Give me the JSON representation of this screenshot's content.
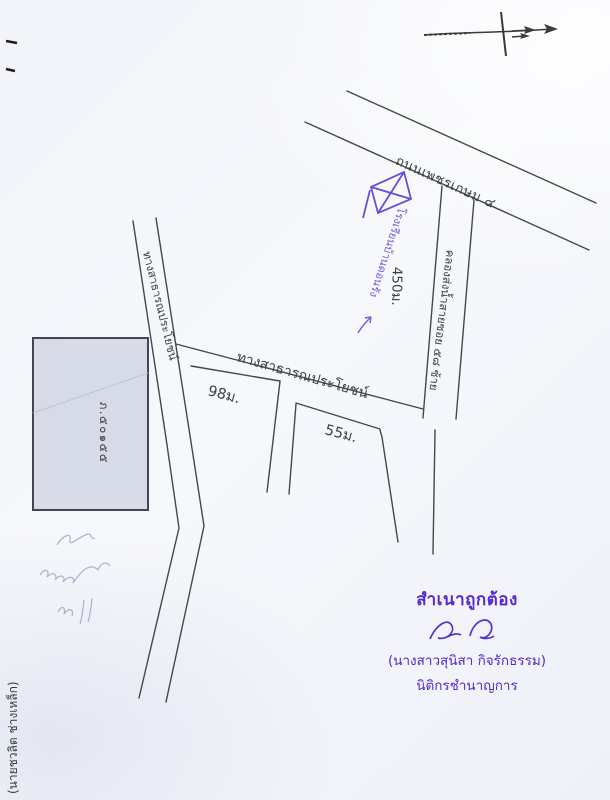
{
  "map": {
    "roads": {
      "phetkasem": {
        "label": "ถนนเพชรเกษม ๔"
      },
      "public_road_diagonal": {
        "label": "ทางสาธารณประโยชน์"
      },
      "public_road_middle": {
        "label": "ทางสาธารณประโยชน์"
      },
      "canal": {
        "label": "คลองส่งน้ำสายซอย ๕๘ ซ้าย"
      }
    },
    "distances": {
      "along_canal": "450ม.",
      "segment_left": "98ม.",
      "segment_right": "55ม."
    },
    "landmarks": {
      "school": {
        "label": "โรงเรียนบ้านดอนรัง"
      },
      "parcel": {
        "label": "ภ.๕๐๑๕๕"
      }
    }
  },
  "certification": {
    "heading": "สำเนาถูกต้อง",
    "name": "(นางสาวสุนิสา  กิจรักธรรม)",
    "title": "นิติกรชำนาญการ"
  },
  "side_note": {
    "name": "(นายชวลิต  ช่างเหล็ก)"
  },
  "colors": {
    "ink_line": "#414b45",
    "stamp_purple": "#5429cf",
    "pen_purple": "#7a5cd8",
    "parcel_fill": "#d7dbe7"
  }
}
